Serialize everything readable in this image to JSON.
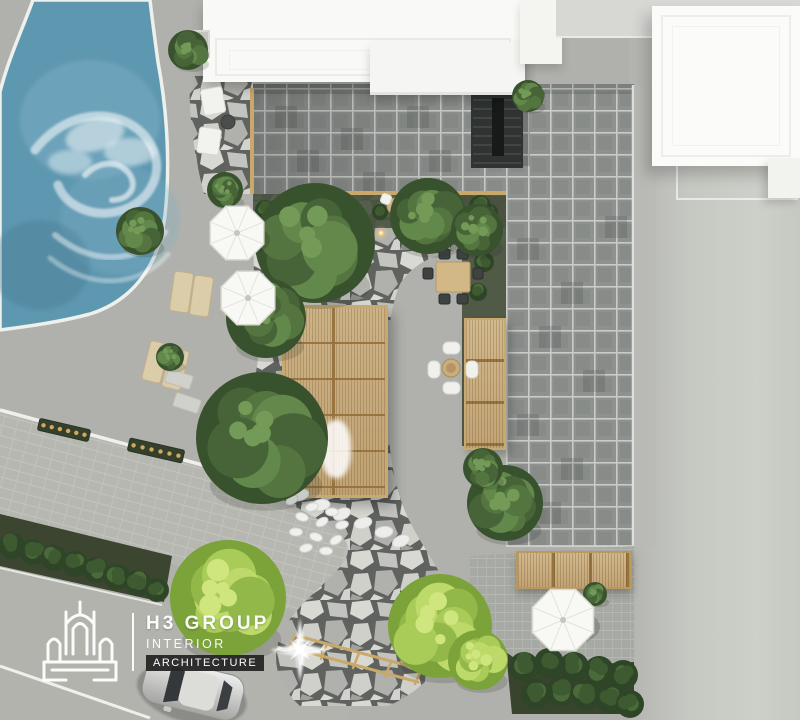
{
  "logo": {
    "company": "H3 GROUP",
    "tagline_line1": "INTERIOR",
    "tagline_line2": "ARCHITECTURE",
    "icon": "building-outline-icon"
  },
  "palette": {
    "pool_water": "#5e97b0",
    "pool_edge": "#eef0ec",
    "concrete": "#b0b1ac",
    "plaza_tile": "#8e918f",
    "tile_grout": "#c9cbc7",
    "flagstone_joint": "#5f625e",
    "flagstone_light": "#d8d9d3",
    "wood_pergola": "#c9b183",
    "wood_beam": "#caa869",
    "tree_dark": "#466438",
    "tree_bright": "#a9cb57",
    "hedge": "#33492b",
    "umbrella": "#f8f8f4",
    "road_right": "#c6c8c2",
    "stair": "#2f3332",
    "building_white": "#fbfcf9",
    "car_body": "#d9dad6",
    "light_warm": "#ffda8e"
  },
  "scene": {
    "trees": [
      {
        "x": 315,
        "y": 243,
        "r": 60,
        "type": "dark"
      },
      {
        "x": 262,
        "y": 438,
        "r": 66,
        "type": "dark"
      },
      {
        "x": 266,
        "y": 318,
        "r": 40,
        "type": "dark"
      },
      {
        "x": 428,
        "y": 216,
        "r": 38,
        "type": "dark"
      },
      {
        "x": 477,
        "y": 230,
        "r": 26,
        "type": "dark"
      },
      {
        "x": 505,
        "y": 503,
        "r": 38,
        "type": "dark"
      },
      {
        "x": 140,
        "y": 231,
        "r": 24,
        "type": "dark"
      },
      {
        "x": 188,
        "y": 50,
        "r": 20,
        "type": "dark"
      },
      {
        "x": 528,
        "y": 96,
        "r": 16,
        "type": "dark"
      },
      {
        "x": 170,
        "y": 357,
        "r": 14,
        "type": "dark"
      },
      {
        "x": 225,
        "y": 190,
        "r": 18,
        "type": "dark"
      },
      {
        "x": 483,
        "y": 468,
        "r": 20,
        "type": "dark"
      },
      {
        "x": 595,
        "y": 594,
        "r": 12,
        "type": "dark"
      },
      {
        "x": 228,
        "y": 598,
        "r": 58,
        "type": "bright"
      },
      {
        "x": 440,
        "y": 626,
        "r": 52,
        "type": "bright"
      },
      {
        "x": 478,
        "y": 660,
        "r": 30,
        "type": "bright"
      }
    ],
    "umbrellas": [
      {
        "x": 237,
        "y": 233,
        "r": 29
      },
      {
        "x": 248,
        "y": 298,
        "r": 29
      },
      {
        "x": 563,
        "y": 620,
        "r": 33
      }
    ],
    "bushes": [
      {
        "x": 12,
        "y": 546,
        "r": 13
      },
      {
        "x": 33,
        "y": 552,
        "r": 13
      },
      {
        "x": 54,
        "y": 558,
        "r": 13
      },
      {
        "x": 75,
        "y": 564,
        "r": 13
      },
      {
        "x": 96,
        "y": 570,
        "r": 13
      },
      {
        "x": 117,
        "y": 577,
        "r": 13
      },
      {
        "x": 138,
        "y": 583,
        "r": 13
      },
      {
        "x": 157,
        "y": 590,
        "r": 12
      },
      {
        "x": 524,
        "y": 667,
        "r": 15
      },
      {
        "x": 549,
        "y": 663,
        "r": 15
      },
      {
        "x": 574,
        "y": 667,
        "r": 15
      },
      {
        "x": 599,
        "y": 671,
        "r": 15
      },
      {
        "x": 623,
        "y": 675,
        "r": 15
      },
      {
        "x": 536,
        "y": 694,
        "r": 15
      },
      {
        "x": 561,
        "y": 691,
        "r": 15
      },
      {
        "x": 586,
        "y": 695,
        "r": 15
      },
      {
        "x": 611,
        "y": 699,
        "r": 15
      },
      {
        "x": 630,
        "y": 704,
        "r": 14
      },
      {
        "x": 265,
        "y": 210,
        "r": 10
      },
      {
        "x": 285,
        "y": 214,
        "r": 9
      },
      {
        "x": 305,
        "y": 210,
        "r": 10
      },
      {
        "x": 380,
        "y": 212,
        "r": 8
      },
      {
        "x": 410,
        "y": 214,
        "r": 9
      },
      {
        "x": 445,
        "y": 212,
        "r": 10
      },
      {
        "x": 470,
        "y": 216,
        "r": 9
      },
      {
        "x": 490,
        "y": 212,
        "r": 8
      },
      {
        "x": 480,
        "y": 206,
        "r": 11
      },
      {
        "x": 476,
        "y": 236,
        "r": 9
      },
      {
        "x": 484,
        "y": 262,
        "r": 10
      },
      {
        "x": 478,
        "y": 292,
        "r": 9
      }
    ],
    "furniture": [
      {
        "type": "lounger",
        "x": 172,
        "y": 272,
        "w": 19,
        "h": 40,
        "rot": 8
      },
      {
        "type": "lounger",
        "x": 192,
        "y": 276,
        "w": 19,
        "h": 40,
        "rot": 8
      },
      {
        "type": "lounger",
        "x": 146,
        "y": 342,
        "w": 19,
        "h": 40,
        "rot": 14
      },
      {
        "type": "lounger",
        "x": 166,
        "y": 349,
        "w": 19,
        "h": 40,
        "rot": 14
      },
      {
        "type": "chair-white",
        "x": 202,
        "y": 88,
        "w": 22,
        "h": 26,
        "rot": -10
      },
      {
        "type": "chair-white",
        "x": 198,
        "y": 128,
        "w": 22,
        "h": 26,
        "rot": 8
      },
      {
        "type": "side-table",
        "x": 228,
        "y": 122,
        "r": 7
      },
      {
        "type": "dining-table",
        "x": 436,
        "y": 262,
        "w": 34,
        "h": 30,
        "rot": 0
      },
      {
        "type": "chair-dark",
        "x": 439,
        "y": 249,
        "w": 11,
        "h": 10,
        "rot": 0
      },
      {
        "type": "chair-dark",
        "x": 457,
        "y": 249,
        "w": 11,
        "h": 10,
        "rot": 0
      },
      {
        "type": "chair-dark",
        "x": 439,
        "y": 294,
        "w": 11,
        "h": 10,
        "rot": 0
      },
      {
        "type": "chair-dark",
        "x": 457,
        "y": 294,
        "w": 11,
        "h": 10,
        "rot": 0
      },
      {
        "type": "chair-dark",
        "x": 423,
        "y": 268,
        "w": 10,
        "h": 11,
        "rot": 0
      },
      {
        "type": "chair-dark",
        "x": 473,
        "y": 268,
        "w": 10,
        "h": 11,
        "rot": 0
      },
      {
        "type": "round-table",
        "x": 451,
        "y": 368,
        "r": 9
      },
      {
        "type": "sofa-seat",
        "x": 443,
        "y": 342,
        "w": 17,
        "h": 12,
        "rot": 0
      },
      {
        "type": "sofa-seat",
        "x": 443,
        "y": 382,
        "w": 17,
        "h": 12,
        "rot": 0
      },
      {
        "type": "sofa-seat",
        "x": 428,
        "y": 361,
        "w": 12,
        "h": 17,
        "rot": 0
      },
      {
        "type": "sofa-seat",
        "x": 466,
        "y": 361,
        "w": 12,
        "h": 17,
        "rot": 0
      },
      {
        "type": "bistro-table",
        "x": 340,
        "y": 208,
        "r": 8
      },
      {
        "type": "bistro-table",
        "x": 395,
        "y": 206,
        "r": 8
      },
      {
        "type": "chair-white",
        "x": 326,
        "y": 196,
        "w": 10,
        "h": 10,
        "rot": 20
      },
      {
        "type": "chair-white",
        "x": 350,
        "y": 216,
        "w": 10,
        "h": 10,
        "rot": 200
      },
      {
        "type": "chair-white",
        "x": 381,
        "y": 194,
        "w": 10,
        "h": 10,
        "rot": 20
      },
      {
        "type": "chair-white",
        "x": 405,
        "y": 214,
        "w": 10,
        "h": 10,
        "rot": 200
      },
      {
        "type": "planter",
        "x": 38,
        "y": 424,
        "w": 52,
        "h": 12,
        "rot": 13
      },
      {
        "type": "planter",
        "x": 128,
        "y": 444,
        "w": 56,
        "h": 13,
        "rot": 13
      },
      {
        "type": "stone",
        "x": 158,
        "y": 348,
        "w": 26,
        "h": 14,
        "rot": 18
      },
      {
        "type": "stone",
        "x": 166,
        "y": 372,
        "w": 26,
        "h": 14,
        "rot": 18
      },
      {
        "type": "stone",
        "x": 174,
        "y": 396,
        "w": 26,
        "h": 14,
        "rot": 18
      }
    ],
    "rocks_edge": [
      [
        216,
        455
      ],
      [
        237,
        465
      ],
      [
        258,
        475
      ],
      [
        279,
        485
      ],
      [
        300,
        495
      ],
      [
        321,
        505
      ],
      [
        342,
        514
      ],
      [
        363,
        523
      ],
      [
        384,
        532
      ],
      [
        401,
        541
      ]
    ],
    "rocks_pile": [
      [
        292,
        500
      ],
      [
        312,
        507
      ],
      [
        332,
        512
      ],
      [
        302,
        517
      ],
      [
        322,
        522
      ],
      [
        342,
        525
      ],
      [
        296,
        532
      ],
      [
        316,
        537
      ],
      [
        336,
        540
      ],
      [
        306,
        548
      ],
      [
        326,
        551
      ]
    ],
    "lights": [
      [
        363,
        240
      ],
      [
        381,
        233
      ],
      [
        399,
        228
      ],
      [
        450,
        233
      ],
      [
        467,
        239
      ],
      [
        424,
        225
      ]
    ],
    "car": {
      "x": 193,
      "y": 689,
      "rot": 14
    },
    "sparkle": {
      "x": 300,
      "y": 650
    }
  }
}
